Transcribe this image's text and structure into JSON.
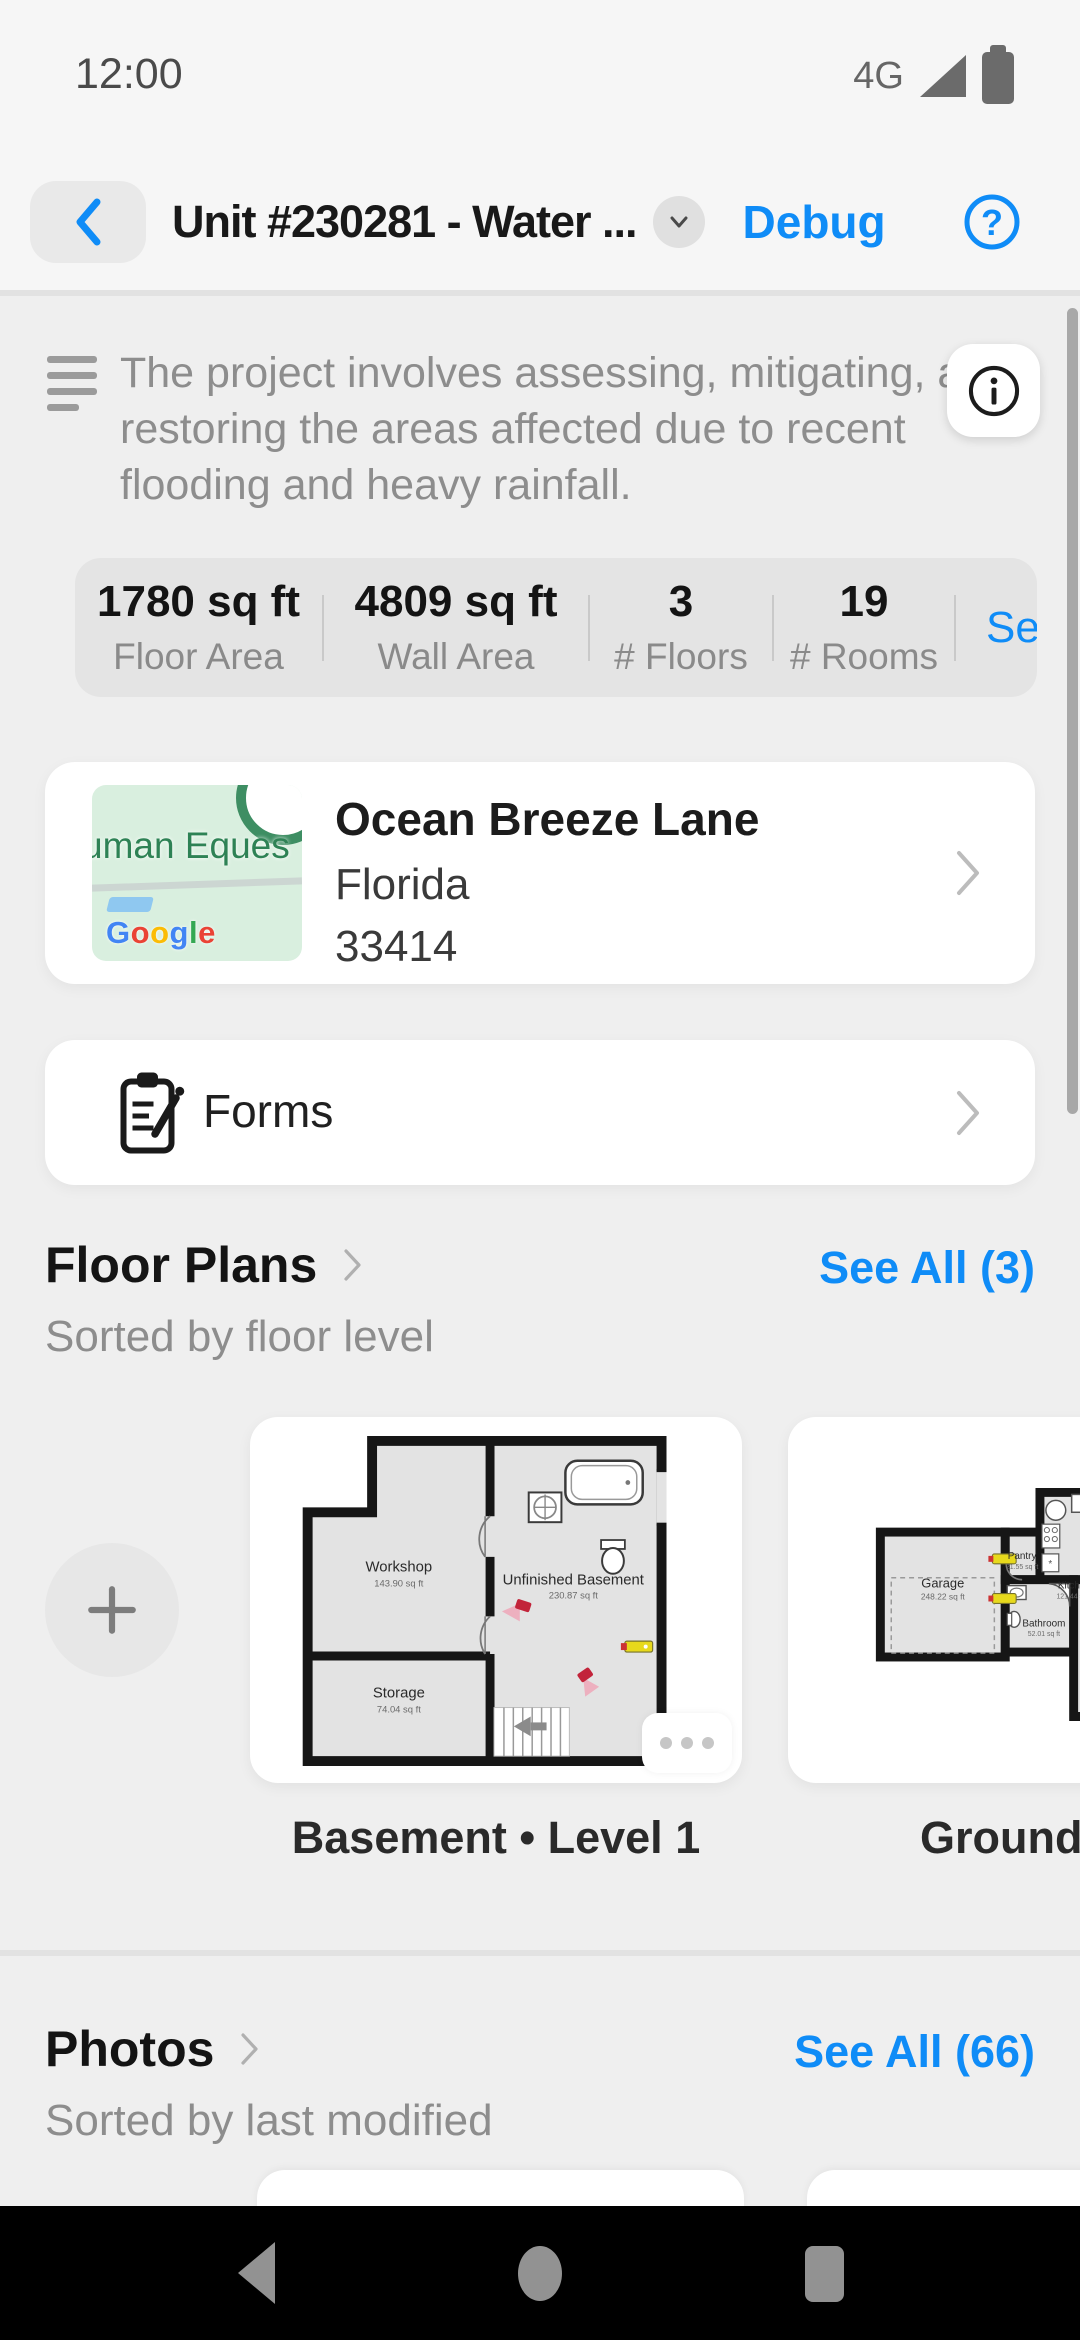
{
  "status_bar": {
    "time": "12:00",
    "network": "4G"
  },
  "header": {
    "title": "Unit #230281 - Water ...",
    "debug": "Debug",
    "help": "?"
  },
  "description": {
    "text": "The project involves assessing, mitigating, and restoring the areas affected due to recent flooding and heavy rainfall."
  },
  "stats": {
    "items": [
      {
        "value": "1780 sq ft",
        "label": "Floor Area"
      },
      {
        "value": "4809 sq ft",
        "label": "Wall Area"
      },
      {
        "value": "3",
        "label": "# Floors"
      },
      {
        "value": "19",
        "label": "# Rooms"
      }
    ],
    "see_all": "See All"
  },
  "address": {
    "street": "Ocean Breeze Lane",
    "state": "Florida",
    "zip": "33414",
    "map_place": "uman Eques",
    "logo": {
      "l1": "G",
      "l2": "o",
      "l3": "o",
      "l4": "g",
      "l5": "l",
      "l6": "e"
    }
  },
  "forms": {
    "label": "Forms"
  },
  "floor_plans": {
    "title": "Floor Plans",
    "see_all": "See All (3)",
    "subtitle": "Sorted by floor level",
    "cards": [
      {
        "label": "Basement • Level 1",
        "rooms": [
          {
            "name": "Workshop",
            "area": "143.90 sq ft"
          },
          {
            "name": "Unfinished Basement",
            "area": "230.87 sq ft"
          },
          {
            "name": "Storage",
            "area": "74.04 sq ft"
          }
        ]
      },
      {
        "label": "Ground F",
        "rooms": [
          {
            "name": "Garage",
            "area": "248.22 sq ft"
          },
          {
            "name": "Pantry",
            "area": "21.55 sq ft"
          },
          {
            "name": "Kitche",
            "area": "121.44 sq"
          },
          {
            "name": "Bathroom",
            "area": "52.01 sq ft"
          }
        ]
      }
    ]
  },
  "photos": {
    "title": "Photos",
    "see_all": "See All (66)",
    "subtitle": "Sorted by last modified"
  },
  "colors": {
    "accent_blue": "#0f8cf7",
    "map_green_bg": "#d9efdf",
    "map_green_text": "#2e8255",
    "navbar": "#000000"
  }
}
